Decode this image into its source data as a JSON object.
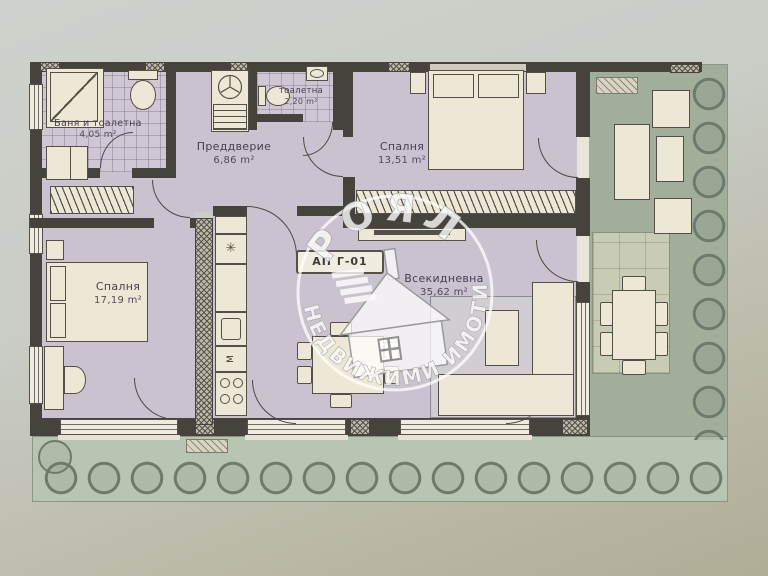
{
  "plan": {
    "apartment_id": "АП Г-01",
    "rooms": {
      "bathroom": {
        "name": "Баня и тоалетна",
        "area": "4,05 m²"
      },
      "toilet": {
        "name": "тоалетна",
        "area": "2,20 m²"
      },
      "vestibule": {
        "name": "Преддверие",
        "area": "6,86 m²"
      },
      "bedroom1": {
        "name": "Спалня",
        "area": "13,51 m²"
      },
      "bedroom2": {
        "name": "Спалня",
        "area": "17,19 m²"
      },
      "living": {
        "name": "Всекидневна",
        "area": "35,62 m²"
      }
    },
    "kitchen": {
      "washer_label": "М",
      "fridge_icon": "✳"
    }
  },
  "watermark": {
    "brand": "РОЯЛ",
    "tagline": "НЕДВИЖИМИ ИМОТИ"
  },
  "colors": {
    "wall": "#46433d",
    "room_floor": "#cbc2cf",
    "furniture": "#ece8d5",
    "terrace_green": "#a0ae9a",
    "garden_green": "#b7c5b3",
    "photo_background": "#c9cdc6"
  }
}
